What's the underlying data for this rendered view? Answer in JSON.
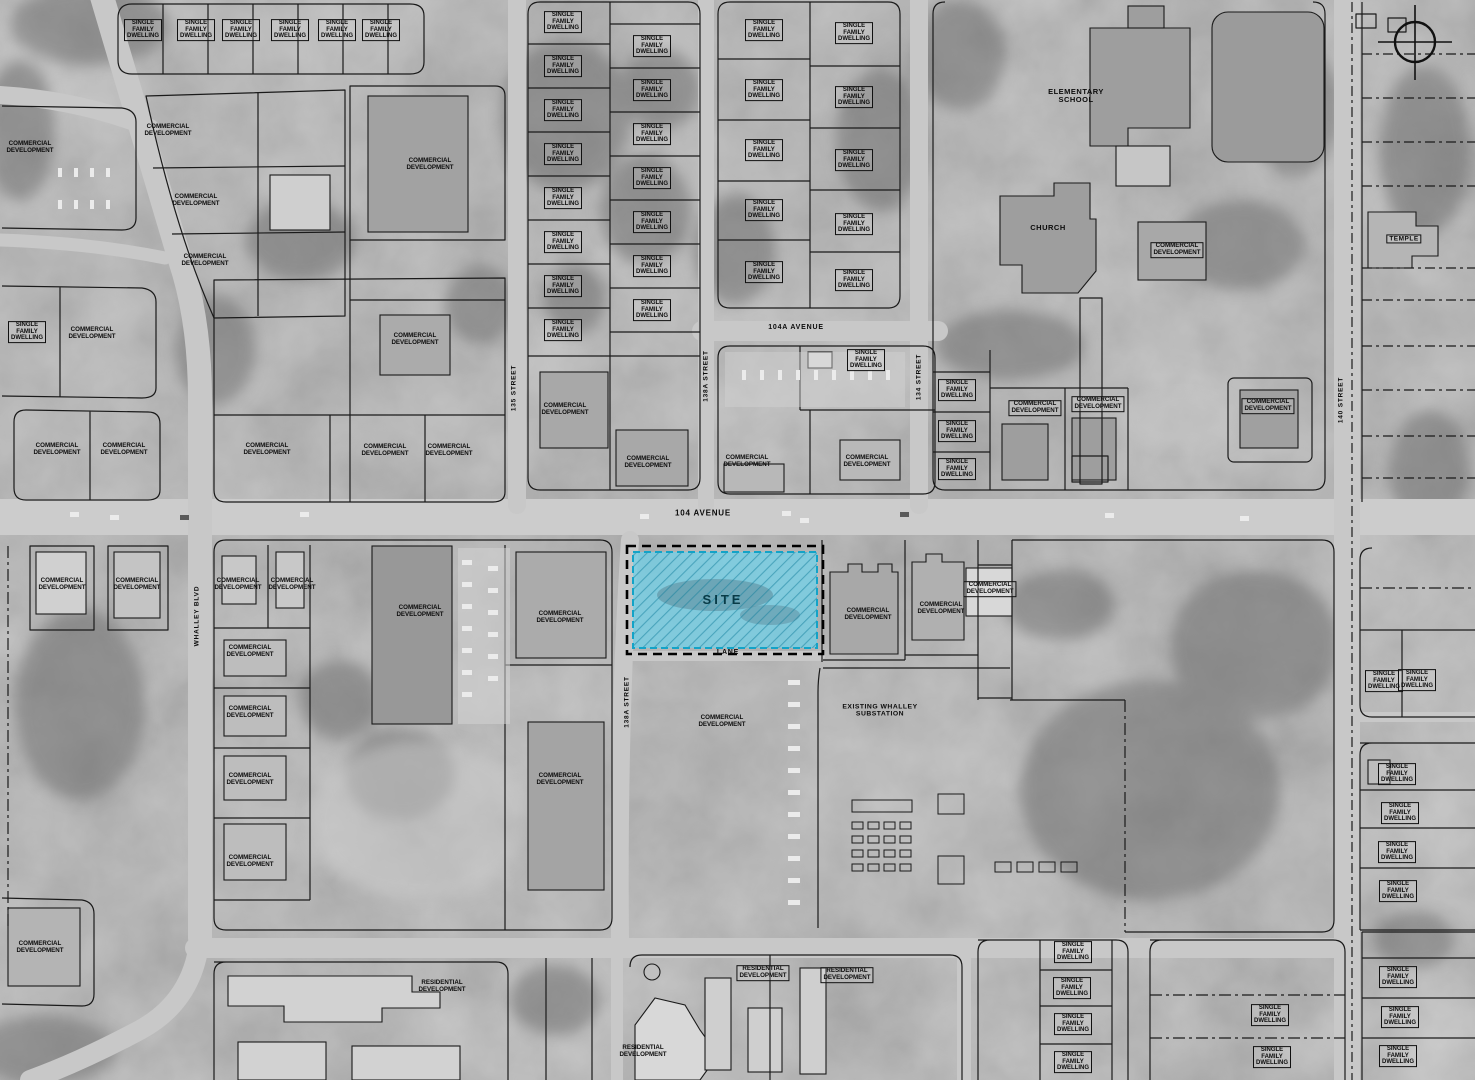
{
  "site": {
    "label": "SITE",
    "fill": "#74cfe6",
    "border": "#13a3c7"
  },
  "colors": {
    "parcel_line": "#1a1a1a",
    "road": "#c6c6c6"
  },
  "labels": [
    {
      "name": "street-label-104-avenue",
      "cls": "street",
      "text": "104 AVENUE",
      "x": 703,
      "y": 514
    },
    {
      "name": "street-label-104a-avenue",
      "cls": "street",
      "text": "104A AVENUE",
      "x": 796,
      "y": 328,
      "size": 7
    },
    {
      "name": "street-label-lane",
      "cls": "street",
      "text": "LANE",
      "x": 728,
      "y": 653,
      "size": 7
    },
    {
      "name": "street-label-whalley-blvd",
      "cls": "street",
      "text": "WHALLEY BLVD",
      "x": 197,
      "y": 616,
      "rot": -90,
      "size": 6.5
    },
    {
      "name": "street-label-135-street",
      "cls": "street",
      "text": "135 STREET",
      "x": 514,
      "y": 388,
      "rot": -90,
      "size": 6.5
    },
    {
      "name": "street-label-138a-street-north",
      "cls": "street",
      "text": "138A STREET",
      "x": 706,
      "y": 376,
      "rot": -90,
      "size": 6.5
    },
    {
      "name": "street-label-134-street",
      "cls": "street",
      "text": "134 STREET",
      "x": 919,
      "y": 377,
      "rot": -90,
      "size": 6.5
    },
    {
      "name": "street-label-140-street",
      "cls": "street",
      "text": "140 STREET",
      "x": 1341,
      "y": 400,
      "rot": -90,
      "size": 6.5
    },
    {
      "name": "street-label-138a-street-south",
      "cls": "street",
      "text": "138A STREET",
      "x": 627,
      "y": 702,
      "rot": -90,
      "size": 6.5
    },
    {
      "name": "elementary-school-label",
      "cls": "poi",
      "text": "ELEMENTARY\nSCHOOL",
      "x": 1076,
      "y": 96
    },
    {
      "name": "church-label",
      "cls": "poi",
      "text": "CHURCH",
      "x": 1048,
      "y": 228
    },
    {
      "name": "temple-label",
      "cls": "poi",
      "text": "TEMPLE",
      "x": 1404,
      "y": 239,
      "box": true,
      "size": 6.5
    },
    {
      "name": "substation-label",
      "cls": "poi",
      "text": "EXISTING WHALLEY\nSUBSTATION",
      "x": 880,
      "y": 711,
      "size": 6.8
    },
    {
      "cls": "sfd",
      "box": true,
      "text": "SINGLE\nFAMILY\nDWELLING",
      "x": 143,
      "y": 30
    },
    {
      "cls": "sfd",
      "box": true,
      "text": "SINGLE\nFAMILY\nDWELLING",
      "x": 196,
      "y": 30
    },
    {
      "cls": "sfd",
      "box": true,
      "text": "SINGLE\nFAMILY\nDWELLING",
      "x": 241,
      "y": 30
    },
    {
      "cls": "sfd",
      "box": true,
      "text": "SINGLE\nFAMILY\nDWELLING",
      "x": 290,
      "y": 30
    },
    {
      "cls": "sfd",
      "box": true,
      "text": "SINGLE\nFAMILY\nDWELLING",
      "x": 337,
      "y": 30
    },
    {
      "cls": "sfd",
      "box": true,
      "text": "SINGLE\nFAMILY\nDWELLING",
      "x": 381,
      "y": 30
    },
    {
      "cls": "sfd",
      "box": true,
      "text": "SINGLE\nFAMILY\nDWELLING",
      "x": 27,
      "y": 332
    },
    {
      "cls": "sfd",
      "box": true,
      "text": "SINGLE\nFAMILY\nDWELLING",
      "x": 563,
      "y": 22
    },
    {
      "cls": "sfd",
      "box": true,
      "text": "SINGLE\nFAMILY\nDWELLING",
      "x": 563,
      "y": 66
    },
    {
      "cls": "sfd",
      "box": true,
      "text": "SINGLE\nFAMILY\nDWELLING",
      "x": 563,
      "y": 110
    },
    {
      "cls": "sfd",
      "box": true,
      "text": "SINGLE\nFAMILY\nDWELLING",
      "x": 563,
      "y": 154
    },
    {
      "cls": "sfd",
      "box": true,
      "text": "SINGLE\nFAMILY\nDWELLING",
      "x": 563,
      "y": 198
    },
    {
      "cls": "sfd",
      "box": true,
      "text": "SINGLE\nFAMILY\nDWELLING",
      "x": 563,
      "y": 242
    },
    {
      "cls": "sfd",
      "box": true,
      "text": "SINGLE\nFAMILY\nDWELLING",
      "x": 563,
      "y": 286
    },
    {
      "cls": "sfd",
      "box": true,
      "text": "SINGLE\nFAMILY\nDWELLING",
      "x": 563,
      "y": 330
    },
    {
      "cls": "sfd",
      "box": true,
      "text": "SINGLE\nFAMILY\nDWELLING",
      "x": 652,
      "y": 46
    },
    {
      "cls": "sfd",
      "box": true,
      "text": "SINGLE\nFAMILY\nDWELLING",
      "x": 652,
      "y": 90
    },
    {
      "cls": "sfd",
      "box": true,
      "text": "SINGLE\nFAMILY\nDWELLING",
      "x": 652,
      "y": 134
    },
    {
      "cls": "sfd",
      "box": true,
      "text": "SINGLE\nFAMILY\nDWELLING",
      "x": 652,
      "y": 178
    },
    {
      "cls": "sfd",
      "box": true,
      "text": "SINGLE\nFAMILY\nDWELLING",
      "x": 652,
      "y": 222
    },
    {
      "cls": "sfd",
      "box": true,
      "text": "SINGLE\nFAMILY\nDWELLING",
      "x": 652,
      "y": 266
    },
    {
      "cls": "sfd",
      "box": true,
      "text": "SINGLE\nFAMILY\nDWELLING",
      "x": 652,
      "y": 310
    },
    {
      "cls": "sfd",
      "box": true,
      "text": "SINGLE\nFAMILY\nDWELLING",
      "x": 764,
      "y": 30
    },
    {
      "cls": "sfd",
      "box": true,
      "text": "SINGLE\nFAMILY\nDWELLING",
      "x": 764,
      "y": 90
    },
    {
      "cls": "sfd",
      "box": true,
      "text": "SINGLE\nFAMILY\nDWELLING",
      "x": 764,
      "y": 150
    },
    {
      "cls": "sfd",
      "box": true,
      "text": "SINGLE\nFAMILY\nDWELLING",
      "x": 764,
      "y": 210
    },
    {
      "cls": "sfd",
      "box": true,
      "text": "SINGLE\nFAMILY\nDWELLING",
      "x": 764,
      "y": 272
    },
    {
      "cls": "sfd",
      "box": true,
      "text": "SINGLE\nFAMILY\nDWELLING",
      "x": 854,
      "y": 33
    },
    {
      "cls": "sfd",
      "box": true,
      "text": "SINGLE\nFAMILY\nDWELLING",
      "x": 854,
      "y": 97
    },
    {
      "cls": "sfd",
      "box": true,
      "text": "SINGLE\nFAMILY\nDWELLING",
      "x": 854,
      "y": 160
    },
    {
      "cls": "sfd",
      "box": true,
      "text": "SINGLE\nFAMILY\nDWELLING",
      "x": 854,
      "y": 224
    },
    {
      "cls": "sfd",
      "box": true,
      "text": "SINGLE\nFAMILY\nDWELLING",
      "x": 854,
      "y": 280
    },
    {
      "cls": "sfd",
      "box": true,
      "text": "SINGLE\nFAMILY\nDWELLING",
      "x": 866,
      "y": 360
    },
    {
      "cls": "sfd",
      "box": true,
      "text": "SINGLE\nFAMILY\nDWELLING",
      "x": 957,
      "y": 390
    },
    {
      "cls": "sfd",
      "box": true,
      "text": "SINGLE\nFAMILY\nDWELLING",
      "x": 957,
      "y": 431
    },
    {
      "cls": "sfd",
      "box": true,
      "text": "SINGLE\nFAMILY\nDWELLING",
      "x": 957,
      "y": 469
    },
    {
      "cls": "sfd",
      "box": true,
      "text": "SINGLE\nFAMILY\nDWELLING",
      "x": 1384,
      "y": 681
    },
    {
      "cls": "sfd",
      "box": true,
      "text": "SINGLE\nFAMILY\nDWELLING",
      "x": 1417,
      "y": 680
    },
    {
      "cls": "sfd",
      "box": true,
      "text": "SINGLE\nFAMILY\nDWELLING",
      "x": 1397,
      "y": 774
    },
    {
      "cls": "sfd",
      "box": true,
      "text": "SINGLE\nFAMILY\nDWELLING",
      "x": 1400,
      "y": 813
    },
    {
      "cls": "sfd",
      "box": true,
      "text": "SINGLE\nFAMILY\nDWELLING",
      "x": 1397,
      "y": 852
    },
    {
      "cls": "sfd",
      "box": true,
      "text": "SINGLE\nFAMILY\nDWELLING",
      "x": 1398,
      "y": 891
    },
    {
      "cls": "sfd",
      "box": true,
      "text": "SINGLE\nFAMILY\nDWELLING",
      "x": 1073,
      "y": 952
    },
    {
      "cls": "sfd",
      "box": true,
      "text": "SINGLE\nFAMILY\nDWELLING",
      "x": 1072,
      "y": 988
    },
    {
      "cls": "sfd",
      "box": true,
      "text": "SINGLE\nFAMILY\nDWELLING",
      "x": 1073,
      "y": 1024
    },
    {
      "cls": "sfd",
      "box": true,
      "text": "SINGLE\nFAMILY\nDWELLING",
      "x": 1073,
      "y": 1062
    },
    {
      "cls": "sfd",
      "box": true,
      "text": "SINGLE\nFAMILY\nDWELLING",
      "x": 1270,
      "y": 1015
    },
    {
      "cls": "sfd",
      "box": true,
      "text": "SINGLE\nFAMILY\nDWELLING",
      "x": 1272,
      "y": 1057
    },
    {
      "cls": "sfd",
      "box": true,
      "text": "SINGLE\nFAMILY\nDWELLING",
      "x": 1398,
      "y": 977
    },
    {
      "cls": "sfd",
      "box": true,
      "text": "SINGLE\nFAMILY\nDWELLING",
      "x": 1400,
      "y": 1017
    },
    {
      "cls": "sfd",
      "box": true,
      "text": "SINGLE\nFAMILY\nDWELLING",
      "x": 1398,
      "y": 1056
    },
    {
      "cls": "comm",
      "text": "COMMERCIAL\nDEVELOPMENT",
      "x": 30,
      "y": 148
    },
    {
      "cls": "comm",
      "text": "COMMERCIAL\nDEVELOPMENT",
      "x": 168,
      "y": 131
    },
    {
      "cls": "comm",
      "text": "COMMERCIAL\nDEVELOPMENT",
      "x": 196,
      "y": 201
    },
    {
      "cls": "comm",
      "text": "COMMERCIAL\nDEVELOPMENT",
      "x": 205,
      "y": 261
    },
    {
      "cls": "comm",
      "text": "COMMERCIAL\nDEVELOPMENT",
      "x": 430,
      "y": 165
    },
    {
      "cls": "comm",
      "text": "COMMERCIAL\nDEVELOPMENT",
      "x": 92,
      "y": 334
    },
    {
      "cls": "comm",
      "text": "COMMERCIAL\nDEVELOPMENT",
      "x": 57,
      "y": 450
    },
    {
      "cls": "comm",
      "text": "COMMERCIAL\nDEVELOPMENT",
      "x": 124,
      "y": 450
    },
    {
      "cls": "comm",
      "text": "COMMERCIAL\nDEVELOPMENT",
      "x": 267,
      "y": 450
    },
    {
      "cls": "comm",
      "text": "COMMERCIAL\nDEVELOPMENT",
      "x": 385,
      "y": 451
    },
    {
      "cls": "comm",
      "text": "COMMERCIAL\nDEVELOPMENT",
      "x": 449,
      "y": 451
    },
    {
      "cls": "comm",
      "text": "COMMERCIAL\nDEVELOPMENT",
      "x": 415,
      "y": 340
    },
    {
      "cls": "comm",
      "text": "COMMERCIAL\nDEVELOPMENT",
      "x": 565,
      "y": 410
    },
    {
      "cls": "comm",
      "text": "COMMERCIAL\nDEVELOPMENT",
      "x": 648,
      "y": 463
    },
    {
      "cls": "comm",
      "text": "COMMERCIAL\nDEVELOPMENT",
      "x": 747,
      "y": 462
    },
    {
      "cls": "comm",
      "text": "COMMERCIAL\nDEVELOPMENT",
      "x": 867,
      "y": 462
    },
    {
      "cls": "comm",
      "box": true,
      "text": "COMMERCIAL\nDEVELOPMENT",
      "x": 1177,
      "y": 250
    },
    {
      "cls": "comm",
      "box": true,
      "text": "COMMERCIAL\nDEVELOPMENT",
      "x": 1035,
      "y": 408
    },
    {
      "cls": "comm",
      "box": true,
      "text": "COMMERCIAL\nDEVELOPMENT",
      "x": 1098,
      "y": 404
    },
    {
      "cls": "comm",
      "box": true,
      "text": "COMMERCIAL\nDEVELOPMENT",
      "x": 1268,
      "y": 406
    },
    {
      "cls": "comm",
      "text": "COMMERCIAL\nDEVELOPMENT",
      "x": 868,
      "y": 615
    },
    {
      "cls": "comm",
      "text": "COMMERCIAL\nDEVELOPMENT",
      "x": 941,
      "y": 609
    },
    {
      "cls": "comm",
      "box": true,
      "text": "COMMERCIAL\nDEVELOPMENT",
      "x": 990,
      "y": 589
    },
    {
      "cls": "comm",
      "text": "COMMERCIAL\nDEVELOPMENT",
      "x": 62,
      "y": 585
    },
    {
      "cls": "comm",
      "text": "COMMERCIAL\nDEVELOPMENT",
      "x": 137,
      "y": 585
    },
    {
      "cls": "comm",
      "text": "COMMERCIAL\nDEVELOPMENT",
      "x": 238,
      "y": 585
    },
    {
      "cls": "comm",
      "text": "COMMERCIAL\nDEVELOPMENT",
      "x": 292,
      "y": 585
    },
    {
      "cls": "comm",
      "text": "COMMERCIAL\nDEVELOPMENT",
      "x": 250,
      "y": 652
    },
    {
      "cls": "comm",
      "text": "COMMERCIAL\nDEVELOPMENT",
      "x": 250,
      "y": 713
    },
    {
      "cls": "comm",
      "text": "COMMERCIAL\nDEVELOPMENT",
      "x": 250,
      "y": 780
    },
    {
      "cls": "comm",
      "text": "COMMERCIAL\nDEVELOPMENT",
      "x": 250,
      "y": 862
    },
    {
      "cls": "comm",
      "text": "COMMERCIAL\nDEVELOPMENT",
      "x": 420,
      "y": 612
    },
    {
      "cls": "comm",
      "text": "COMMERCIAL\nDEVELOPMENT",
      "x": 560,
      "y": 618
    },
    {
      "cls": "comm",
      "text": "COMMERCIAL\nDEVELOPMENT",
      "x": 560,
      "y": 780
    },
    {
      "cls": "comm",
      "text": "COMMERCIAL\nDEVELOPMENT",
      "x": 40,
      "y": 948
    },
    {
      "cls": "comm",
      "text": "COMMERCIAL\nDEVELOPMENT",
      "x": 722,
      "y": 722
    },
    {
      "cls": "res",
      "text": "RESIDENTIAL\nDEVELOPMENT",
      "x": 442,
      "y": 987
    },
    {
      "cls": "res",
      "text": "RESIDENTIAL\nDEVELOPMENT",
      "x": 643,
      "y": 1052
    },
    {
      "cls": "res",
      "box": true,
      "text": "RESIDENTIAL\nDEVELOPMENT",
      "x": 763,
      "y": 973
    },
    {
      "cls": "res",
      "box": true,
      "text": "RESIDENTIAL\nDEVELOPMENT",
      "x": 847,
      "y": 975
    }
  ]
}
